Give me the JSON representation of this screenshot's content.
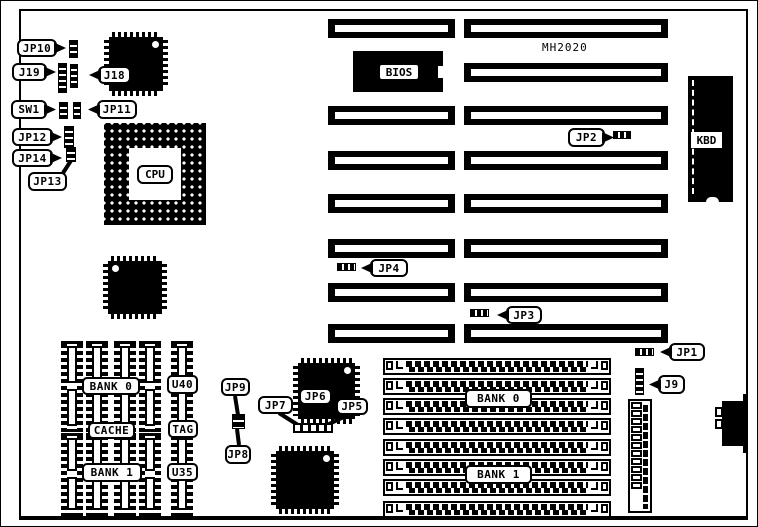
{
  "title": {
    "text": "MH2020"
  },
  "cpu": {
    "label": "CPU"
  },
  "bios": {
    "label": "BIOS"
  },
  "kbd": {
    "label": "KBD"
  },
  "colors": {
    "ink": "#000000",
    "paper": "#ffffff"
  },
  "labels": [
    {
      "id": "jp10",
      "text": "JP10",
      "kind": "callout",
      "pointer": "right",
      "x": 16,
      "y": 38,
      "w": 40,
      "h": 18
    },
    {
      "id": "j19",
      "text": "J19",
      "kind": "callout",
      "pointer": "right",
      "x": 11,
      "y": 62,
      "w": 35,
      "h": 18
    },
    {
      "id": "j18",
      "text": "J18",
      "kind": "callout",
      "pointer": "left",
      "x": 97,
      "y": 65,
      "w": 33,
      "h": 18
    },
    {
      "id": "sw1",
      "text": "SW1",
      "kind": "callout",
      "pointer": "right",
      "x": 10,
      "y": 99,
      "w": 36,
      "h": 19
    },
    {
      "id": "jp11",
      "text": "JP11",
      "kind": "callout",
      "pointer": "left",
      "x": 96,
      "y": 99,
      "w": 40,
      "h": 19
    },
    {
      "id": "jp12",
      "text": "JP12",
      "kind": "callout",
      "pointer": "right",
      "x": 11,
      "y": 127,
      "w": 41,
      "h": 18
    },
    {
      "id": "jp14",
      "text": "JP14",
      "kind": "callout",
      "pointer": "right",
      "x": 11,
      "y": 148,
      "w": 41,
      "h": 18
    },
    {
      "id": "jp13",
      "text": "JP13",
      "kind": "callout",
      "pointer": "none",
      "x": 27,
      "y": 171,
      "w": 39,
      "h": 19
    },
    {
      "id": "jp2",
      "text": "JP2",
      "kind": "callout",
      "pointer": "right",
      "x": 567,
      "y": 127,
      "w": 37,
      "h": 19
    },
    {
      "id": "jp4",
      "text": "JP4",
      "kind": "callout",
      "pointer": "left",
      "x": 369,
      "y": 258,
      "w": 38,
      "h": 18
    },
    {
      "id": "jp3",
      "text": "JP3",
      "kind": "callout",
      "pointer": "left",
      "x": 505,
      "y": 305,
      "w": 36,
      "h": 18
    },
    {
      "id": "jp1",
      "text": "JP1",
      "kind": "callout",
      "pointer": "left",
      "x": 668,
      "y": 342,
      "w": 36,
      "h": 18
    },
    {
      "id": "j9",
      "text": "J9",
      "kind": "callout",
      "pointer": "left",
      "x": 657,
      "y": 374,
      "w": 27,
      "h": 19
    },
    {
      "id": "jp9",
      "text": "JP9",
      "kind": "callout",
      "pointer": "none",
      "x": 220,
      "y": 377,
      "w": 29,
      "h": 18
    },
    {
      "id": "jp8",
      "text": "JP8",
      "kind": "callout",
      "pointer": "none",
      "x": 224,
      "y": 444,
      "w": 26,
      "h": 19
    },
    {
      "id": "jp7",
      "text": "JP7",
      "kind": "callout",
      "pointer": "none",
      "x": 257,
      "y": 395,
      "w": 35,
      "h": 18
    },
    {
      "id": "jp6",
      "text": "JP6",
      "kind": "callout",
      "pointer": "down",
      "x": 298,
      "y": 387,
      "w": 33,
      "h": 17
    },
    {
      "id": "jp5",
      "text": "JP5",
      "kind": "callout",
      "pointer": "none",
      "x": 335,
      "y": 397,
      "w": 32,
      "h": 17
    },
    {
      "id": "bank0-cache",
      "text": "BANK 0",
      "kind": "tag",
      "pointer": "none",
      "x": 81,
      "y": 376,
      "w": 58,
      "h": 18
    },
    {
      "id": "cache",
      "text": "CACHE",
      "kind": "tag",
      "pointer": "none",
      "x": 87,
      "y": 421,
      "w": 47,
      "h": 17
    },
    {
      "id": "bank1-cache",
      "text": "BANK 1",
      "kind": "tag",
      "pointer": "none",
      "x": 81,
      "y": 462,
      "w": 60,
      "h": 19
    },
    {
      "id": "u40",
      "text": "U40",
      "kind": "tag",
      "pointer": "none",
      "x": 166,
      "y": 374,
      "w": 31,
      "h": 19
    },
    {
      "id": "tag",
      "text": "TAG",
      "kind": "tag",
      "pointer": "none",
      "x": 167,
      "y": 419,
      "w": 30,
      "h": 18
    },
    {
      "id": "u35",
      "text": "U35",
      "kind": "tag",
      "pointer": "none",
      "x": 166,
      "y": 462,
      "w": 31,
      "h": 18
    },
    {
      "id": "bank0-simm",
      "text": "BANK 0",
      "kind": "tag",
      "pointer": "none",
      "x": 464,
      "y": 388,
      "w": 67,
      "h": 19
    },
    {
      "id": "bank1-simm",
      "text": "BANK 1",
      "kind": "tag",
      "pointer": "none",
      "x": 464,
      "y": 464,
      "w": 67,
      "h": 19
    }
  ],
  "headers": [
    {
      "id": "jp10-header",
      "type": "v",
      "x": 68,
      "y": 39,
      "w": 9,
      "h": 18
    },
    {
      "id": "j19-header-a",
      "type": "v",
      "x": 57,
      "y": 62,
      "w": 9,
      "h": 30
    },
    {
      "id": "j19-header-b",
      "type": "v",
      "x": 69,
      "y": 63,
      "w": 8,
      "h": 24
    },
    {
      "id": "sw1-header-a",
      "type": "v",
      "x": 58,
      "y": 101,
      "w": 9,
      "h": 17
    },
    {
      "id": "sw1-header-b",
      "type": "v",
      "x": 72,
      "y": 101,
      "w": 8,
      "h": 17
    },
    {
      "id": "jp12-header",
      "type": "v",
      "x": 63,
      "y": 125,
      "w": 10,
      "h": 22
    },
    {
      "id": "jp14-header",
      "type": "v",
      "x": 65,
      "y": 146,
      "w": 10,
      "h": 15
    },
    {
      "id": "j9-header",
      "type": "v",
      "x": 634,
      "y": 367,
      "w": 9,
      "h": 27
    },
    {
      "id": "jp2-jumper",
      "type": "h",
      "x": 612,
      "y": 130,
      "w": 18,
      "h": 8
    },
    {
      "id": "jp4-jumper",
      "type": "h",
      "x": 336,
      "y": 262,
      "w": 19,
      "h": 8
    },
    {
      "id": "jp3-jumper",
      "type": "h",
      "x": 469,
      "y": 308,
      "w": 19,
      "h": 8
    },
    {
      "id": "jp1-jumper",
      "type": "h",
      "x": 634,
      "y": 347,
      "w": 19,
      "h": 8
    },
    {
      "id": "jp9-block",
      "type": "block",
      "x": 231,
      "y": 413,
      "w": 13,
      "h": 15
    },
    {
      "id": "jp567-strip",
      "type": "strip",
      "x": 292,
      "y": 422,
      "w": 40,
      "h": 10
    }
  ],
  "isa_slots": {
    "columns": [
      {
        "id": "left",
        "x": 327,
        "w": 127,
        "h": 19,
        "ys": [
          18,
          105,
          150,
          193,
          238,
          282,
          323
        ]
      },
      {
        "id": "right",
        "x": 463,
        "w": 204,
        "h": 19,
        "ys": [
          18,
          62,
          105,
          150,
          193,
          238,
          282,
          323
        ]
      }
    ]
  },
  "simm": {
    "x": 382,
    "w": 228,
    "h": 17,
    "ys": [
      357,
      377,
      397,
      417,
      438,
      458,
      478,
      500
    ]
  },
  "dip_group": {
    "cols": [
      60,
      85,
      113,
      138,
      170
    ],
    "w": 22,
    "rows": [
      {
        "y": 340,
        "h": 91
      },
      {
        "y": 432,
        "h": 83
      }
    ]
  },
  "qfp_chips": [
    {
      "id": "qfp-top-left",
      "x": 103,
      "y": 31,
      "w": 64,
      "h": 64,
      "dot": "tr"
    },
    {
      "id": "qfp-below-cpu",
      "x": 102,
      "y": 255,
      "w": 64,
      "h": 63,
      "dot": "tl"
    },
    {
      "id": "qfp-middle-top",
      "x": 292,
      "y": 357,
      "w": 67,
      "h": 66,
      "dot": "tr"
    },
    {
      "id": "qfp-middle-bottom",
      "x": 270,
      "y": 445,
      "w": 68,
      "h": 68,
      "dot": "tr"
    }
  ],
  "berg_connector": {
    "x": 627,
    "y": 398,
    "w": 24,
    "h": 114,
    "boxes": 11
  },
  "power_connector": {
    "main": {
      "x": 721,
      "y": 400,
      "w": 26,
      "h": 45
    },
    "tabs": [
      {
        "x": 742,
        "y": 393,
        "w": 5,
        "h": 8
      },
      {
        "x": 742,
        "y": 444,
        "w": 5,
        "h": 8
      }
    ],
    "boxes": [
      {
        "x": 714,
        "y": 406
      },
      {
        "x": 714,
        "y": 418
      }
    ]
  },
  "lines": [
    {
      "x1": 62,
      "y1": 172,
      "x2": 71,
      "y2": 158
    },
    {
      "x1": 234,
      "y1": 395,
      "x2": 237,
      "y2": 414
    },
    {
      "x1": 238,
      "y1": 444,
      "x2": 236,
      "y2": 428
    },
    {
      "x1": 278,
      "y1": 412,
      "x2": 297,
      "y2": 424
    },
    {
      "x1": 347,
      "y1": 414,
      "x2": 326,
      "y2": 424
    }
  ]
}
